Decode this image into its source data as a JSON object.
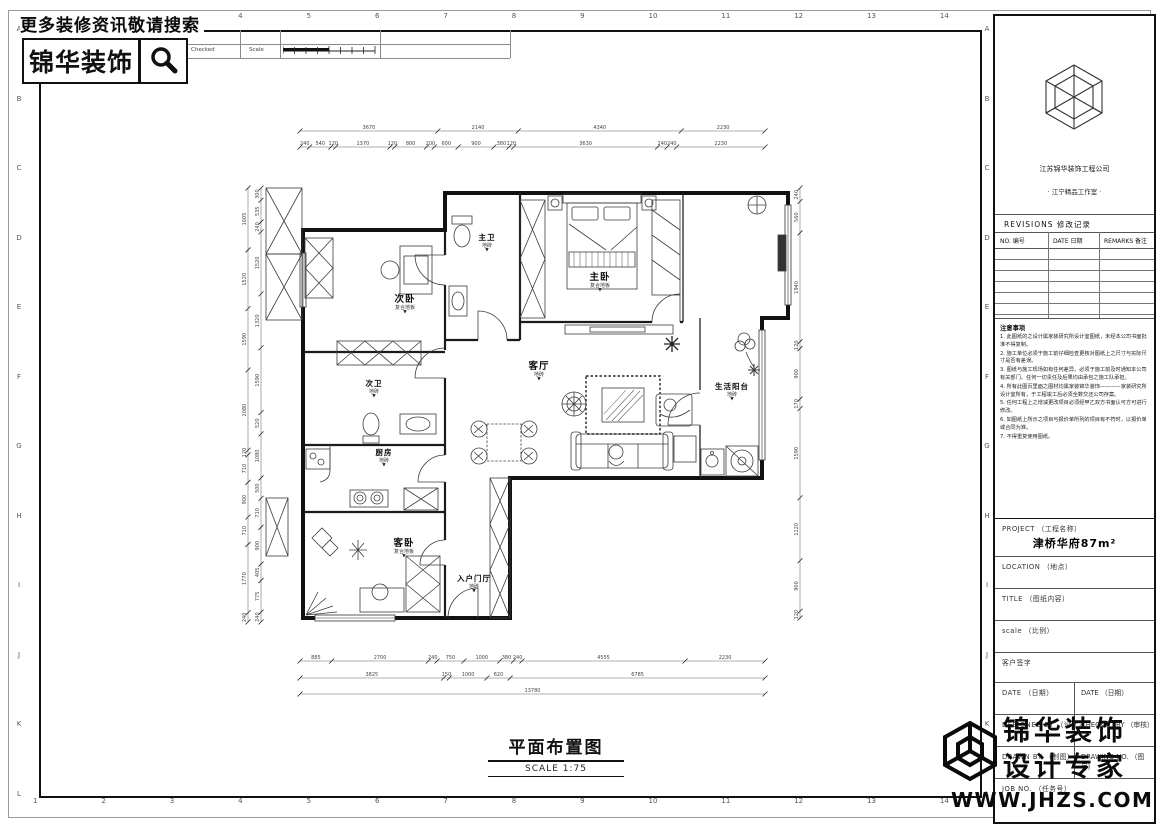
{
  "page": {
    "search_banner": "更多装修资讯敬请搜索",
    "brand": "锦华装饰",
    "plan_title": "平面布置图",
    "plan_scale": "SCALE  1:75",
    "watermark_line1": "锦华装饰",
    "watermark_line2": "设计专家",
    "watermark_url": "WWW.JHZS.COM"
  },
  "header_table": {
    "revision": "Revision",
    "signature": "Signature",
    "checked": "Checked",
    "scale": "Scale"
  },
  "grid": {
    "numbers": [
      "1",
      "2",
      "3",
      "4",
      "5",
      "6",
      "7",
      "8",
      "9",
      "10",
      "11",
      "12",
      "13",
      "14"
    ],
    "letters": [
      "A",
      "B",
      "C",
      "D",
      "E",
      "F",
      "G",
      "H",
      "I",
      "J",
      "K",
      "L"
    ]
  },
  "titleblock": {
    "company": "江苏锦华装饰工程公司",
    "studio": "· 江宁精品工作室 ·",
    "revisions_title": "REVISIONS  修改记录",
    "rev_cols": [
      "NO. 编号",
      "DATE 日期",
      "REMARKS 备注"
    ],
    "notes_title": "注意事项",
    "notes": [
      "1. 此图纸的之设计属家装研究所设计室图纸，未经本公司书面批准不得复制。",
      "2. 施工单位必须于施工前仔细检查更核对图纸上之尺寸与实际尺寸是否有差误。",
      "3. 图纸与施工现场如有任何差异，必须于施工前及时通知本公司有关部门，任何一切责任及后果均由承包之施工队承担。",
      "4. 所有此图页里面之图材均属家装锦华装饰————家装研究所设计室所有，于工程竣工后必须全数交还公司存案。",
      "5. 任何工程上之增减更改项目必须经甲乙双方书面认可方可进行修改。",
      "6. 如图纸上所示之项目与报价单所列的项目有不符时，以报价单或合同为准。",
      "7. 不得重复使用图纸。"
    ],
    "project_label": "PROJECT （工程名称）",
    "project_value": "津桥华府87m²",
    "location_label": "LOCATION （地点）",
    "title_label": "TITLE （图纸内容）",
    "scale_label": "scale （比例）",
    "client_label": "客户签字",
    "date_label_left": "DATE （日期）",
    "date_label_right": "DATE （日期）",
    "designed_label": "DESIGNED BY （设计）",
    "checked_label": "CHECKED BY （审核）",
    "drawn_label": "DRAWN BY （制图）",
    "drawing_no_label": "DRAWING NO. （图号）",
    "job_label": "JOB NO. （任务号）"
  },
  "plan": {
    "level_glyph": "▼",
    "rooms": [
      {
        "name": "主卧",
        "material": "复合地板"
      },
      {
        "name": "主卫",
        "material": "地砖"
      },
      {
        "name": "次卧",
        "material": "复合地板"
      },
      {
        "name": "次卫",
        "material": "地砖"
      },
      {
        "name": "厨房",
        "material": "地砖"
      },
      {
        "name": "客卧",
        "material": "复合地板"
      },
      {
        "name": "客厅",
        "material": "地砖"
      },
      {
        "name": "生活阳台",
        "material": "地砖"
      },
      {
        "name": "入户门厅",
        "material": "地砖"
      }
    ],
    "dims": {
      "top_outer": [
        "3670",
        "2140",
        "4340",
        "2230"
      ],
      "top_inner": [
        "240",
        "540",
        "120",
        "1370",
        "120",
        "800",
        "200",
        "600",
        "900",
        "380",
        "120",
        "3630",
        "240",
        "240",
        "2230"
      ],
      "bottom_row1": [
        "885",
        "2700",
        "240",
        "750",
        "1000",
        "380",
        "240",
        "4555",
        "2230"
      ],
      "bottom_row2": [
        "3825",
        "150",
        "1000",
        "620",
        "6785"
      ],
      "bottom_total": [
        "13780"
      ],
      "left_outer": [
        "1605",
        "1520",
        "1590",
        "2080",
        "120",
        "710",
        "900",
        "710",
        "1770",
        "240"
      ],
      "left_inner": [
        "300",
        "535",
        "240",
        "1520",
        "1320",
        "1590",
        "520",
        "1080",
        "500",
        "710",
        "900",
        "405",
        "775",
        "240"
      ],
      "right_inner": [
        "240",
        "560",
        "1940",
        "120",
        "900",
        "170",
        "1590",
        "1120",
        "900",
        "120"
      ]
    }
  }
}
